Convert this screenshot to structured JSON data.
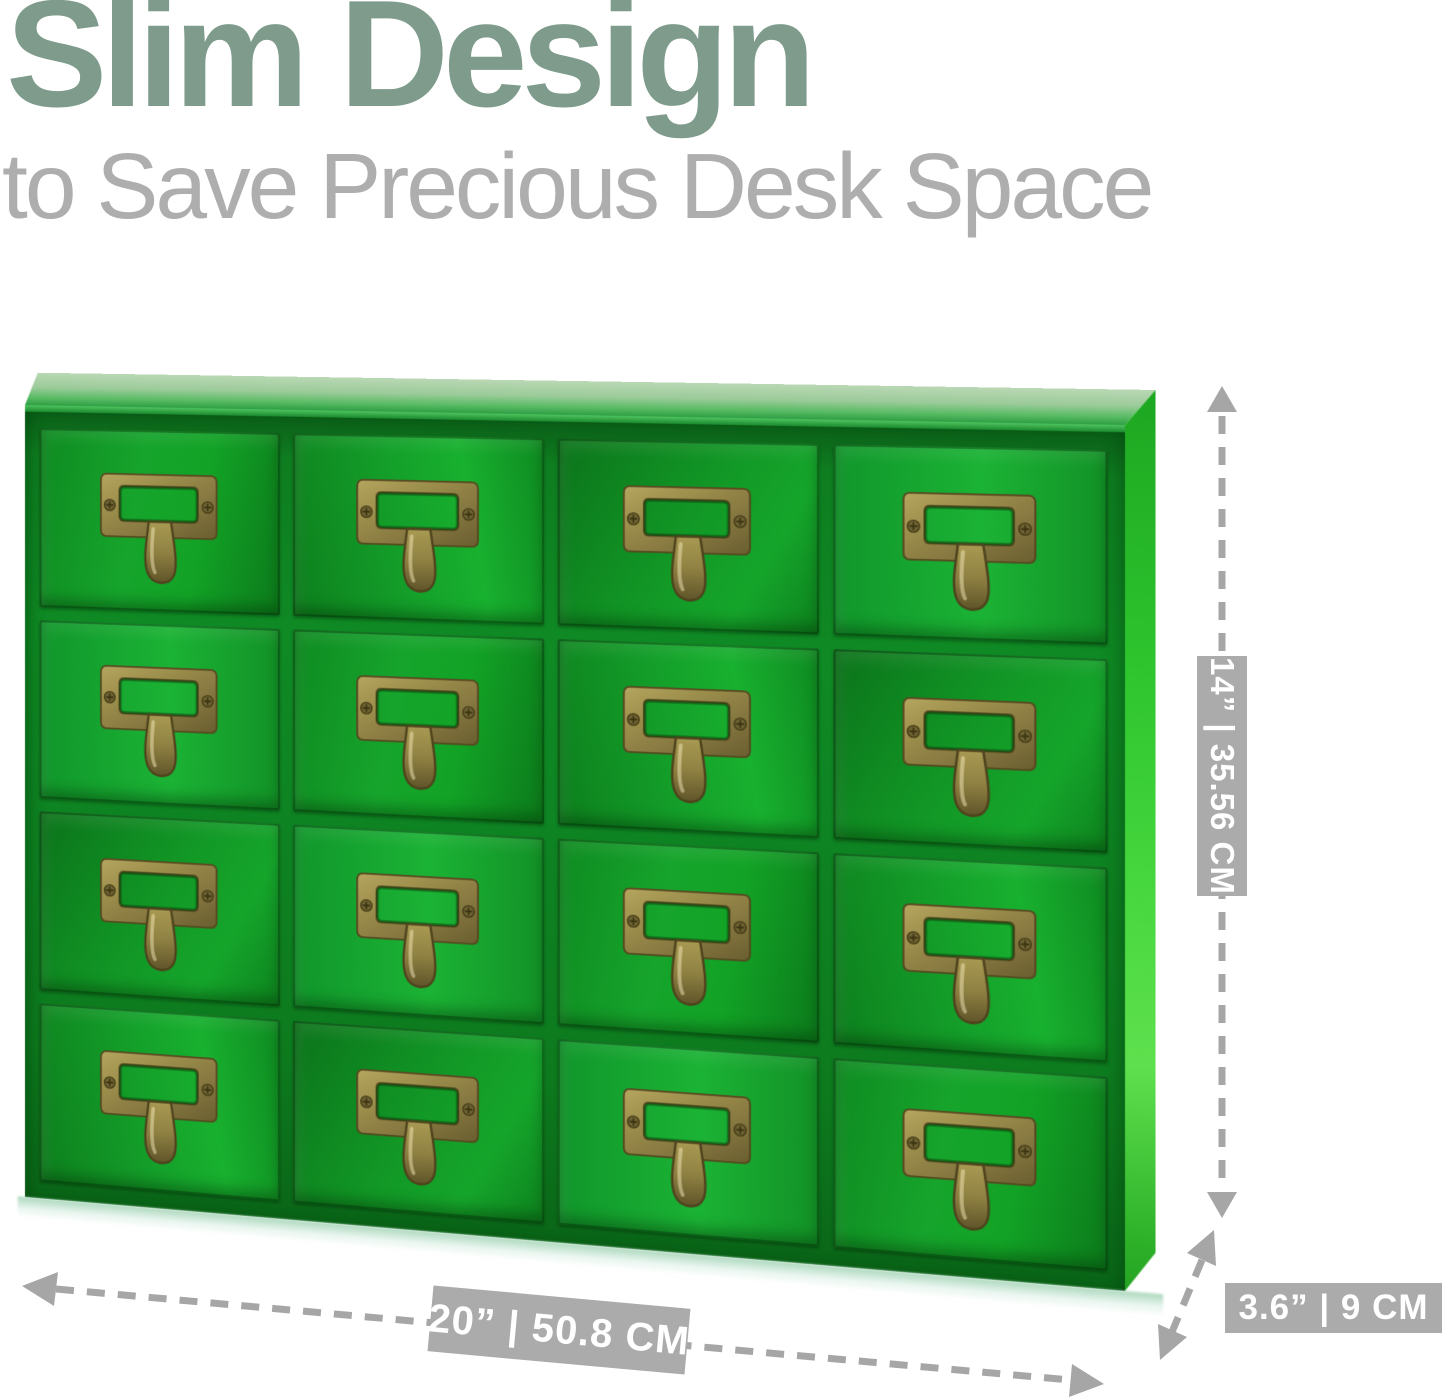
{
  "header": {
    "title": "Slim Design",
    "subtitle": "to Save Precious Desk Space"
  },
  "product": {
    "drawer_rows": 4,
    "drawer_cols": 4,
    "drawer_count": 16
  },
  "dimensions": {
    "height": "14” | 35.56 CM",
    "width": "20” | 50.8 CM",
    "depth": "3.6” | 9 CM"
  },
  "colors": {
    "title_green": "#7e9b8c",
    "subtitle_gray": "#aeaeae",
    "annotation_gray": "#ababab",
    "label_text": "#ffffff",
    "cabinet_green": "#12982a",
    "cabinet_frame_green": "#0c6f1c",
    "cabinet_side_green": "#3ecf35",
    "cabinet_top_green": "#9ccb9a",
    "brass": "#8d7f42"
  }
}
